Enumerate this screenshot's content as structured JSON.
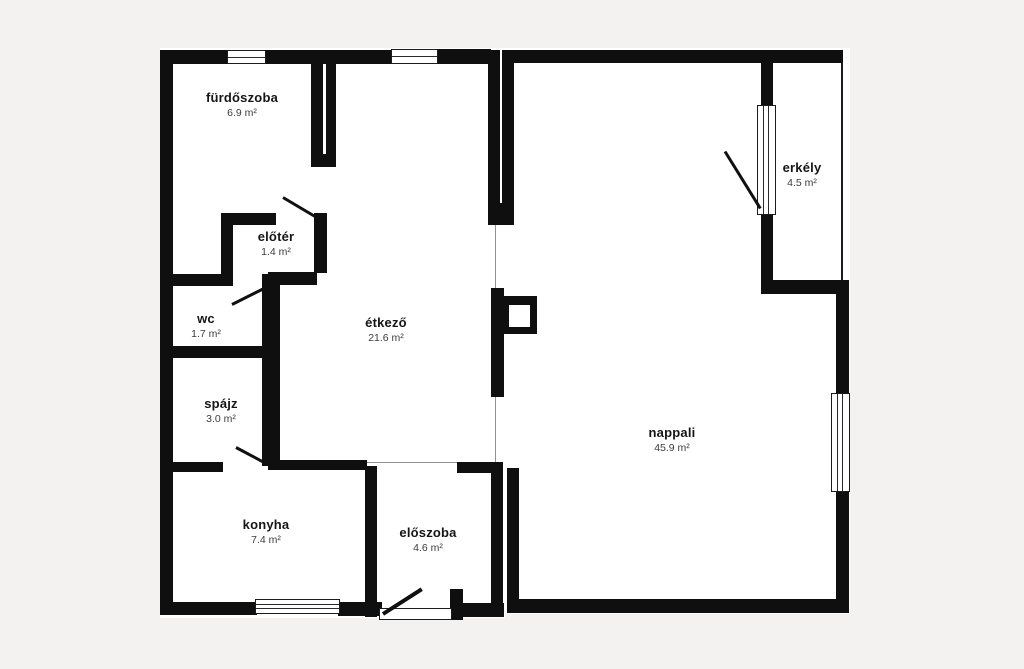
{
  "diagram_type": "apartment-floor-plan",
  "language": "hu",
  "colors": {
    "wall": "#0f0f0f",
    "background": "#f3f2f0",
    "floor": "#ffffff",
    "boundary_line": "#909090"
  },
  "rooms": [
    {
      "id": "furdoszoba",
      "name": "fürdőszoba",
      "area": "6.9 m²"
    },
    {
      "id": "eloter",
      "name": "előtér",
      "area": "1.4 m²"
    },
    {
      "id": "wc",
      "name": "wc",
      "area": "1.7 m²"
    },
    {
      "id": "spajz",
      "name": "spájz",
      "area": "3.0 m²"
    },
    {
      "id": "etkezo",
      "name": "étkező",
      "area": "21.6 m²"
    },
    {
      "id": "konyha",
      "name": "konyha",
      "area": "7.4 m²"
    },
    {
      "id": "eloszoba",
      "name": "előszoba",
      "area": "4.6 m²"
    },
    {
      "id": "nappali",
      "name": "nappali",
      "area": "45.9 m²"
    },
    {
      "id": "erkely",
      "name": "erkély",
      "area": "4.5 m²"
    }
  ]
}
